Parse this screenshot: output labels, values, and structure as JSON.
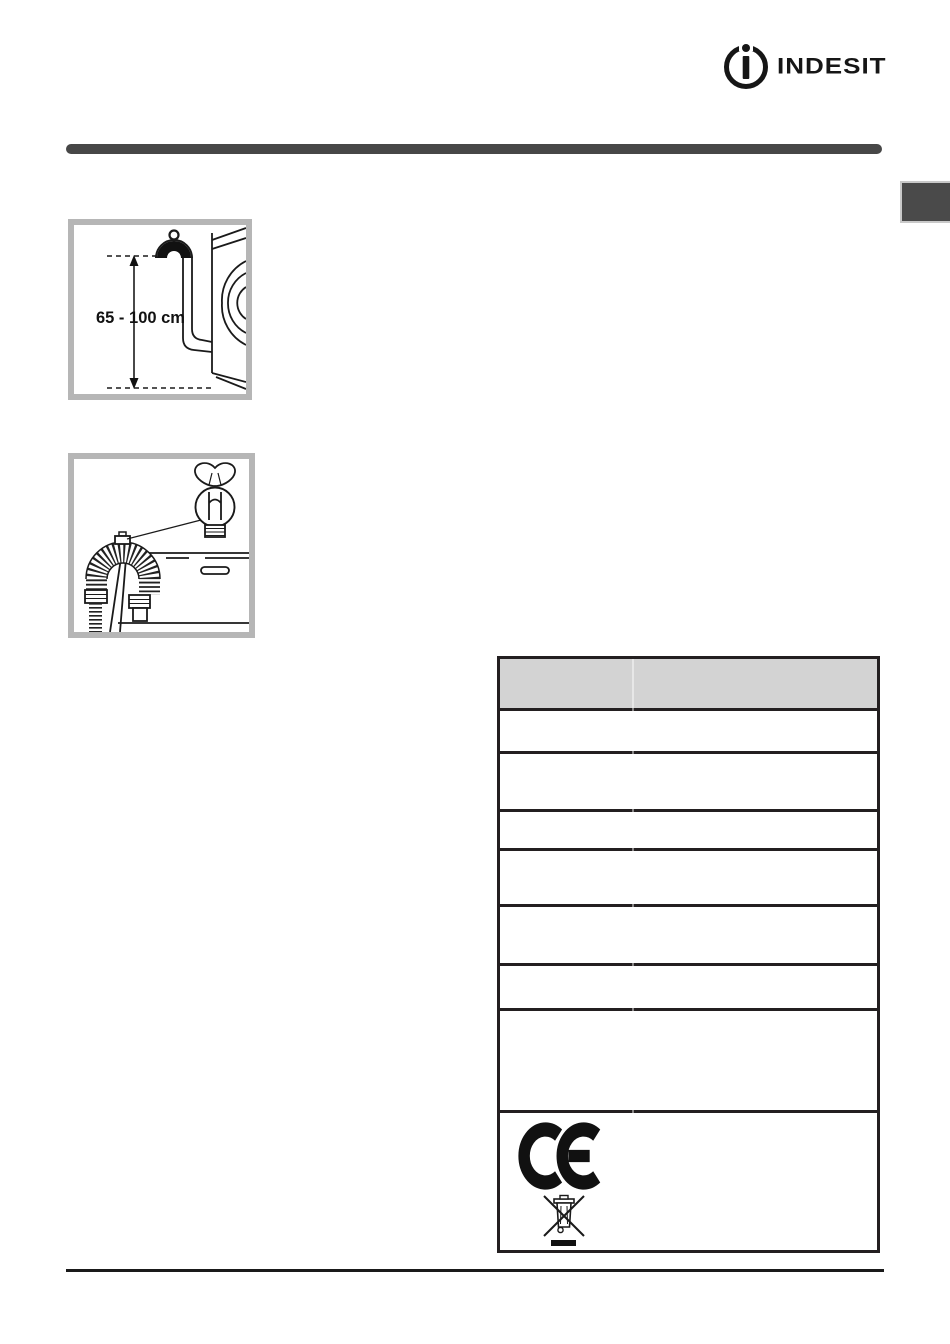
{
  "page": {
    "kind": "appliance-manual-installation-page"
  },
  "logo": {
    "brand": "INDESIT",
    "mark": "circle-i-icon"
  },
  "figures": {
    "drain_hose_height": {
      "measurement_label": "65 - 100 cm",
      "depicts": "drain hose hooked at wall height beside washing machine"
    },
    "drain_hose_sink": {
      "depicts": "corrugated drain hose hung over sink edge with hose-guide detail circle"
    }
  },
  "table": {
    "header_text": "",
    "empty_body_row_count": 7,
    "symbols": {
      "ce": "ce-mark-icon",
      "weee": "weee-crossed-bin-icon"
    }
  },
  "colors": {
    "top_bar_color": "#474747",
    "tab_color": "#4a4a4a",
    "rule_color": "#1a1a1a",
    "figure_border_color": "#b6b6b6",
    "table_border_color": "#231f20",
    "table_header_bg": "#d3d3d3"
  }
}
